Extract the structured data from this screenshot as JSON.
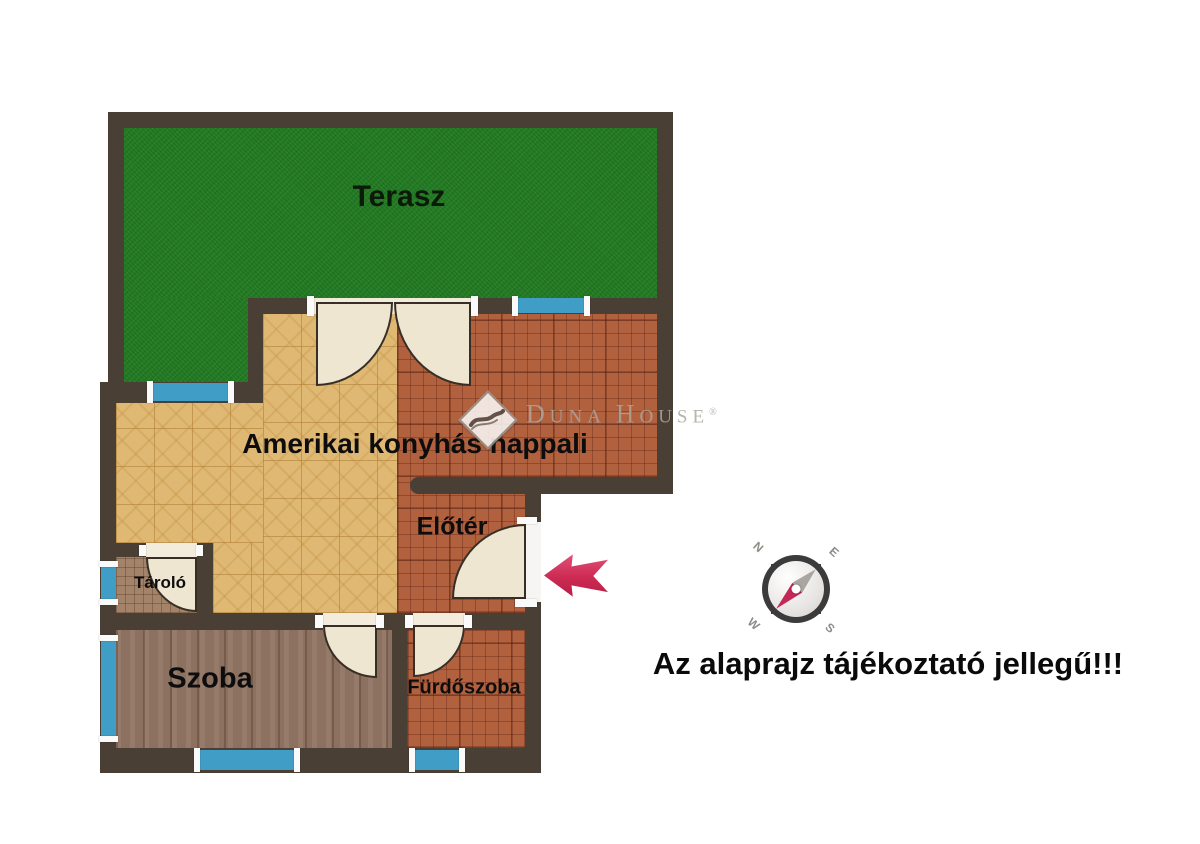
{
  "floorplan": {
    "rooms": {
      "terrace": {
        "label": "Terasz"
      },
      "living": {
        "label": "Amerikai konyhás nappali"
      },
      "foyer": {
        "label": "Előtér"
      },
      "storage": {
        "label": "Tároló"
      },
      "room": {
        "label": "Szoba"
      },
      "bathroom": {
        "label": "Fürdőszoba"
      }
    },
    "disclaimer": "Az alaprajz tájékoztató jellegű!!!",
    "watermark": {
      "d_initial": "D",
      "una": "UNA",
      "h_initial": "H",
      "ouse": "OUSE",
      "registered": "®",
      "icon": "duna-house-diamond-wave-icon"
    },
    "compass": {
      "icon": "compass-rose-icon",
      "north": "N",
      "east": "E",
      "west": "W",
      "south": "S"
    },
    "entrance_marker": {
      "icon": "entrance-arrow-icon",
      "direction": "left"
    },
    "colors": {
      "wall": "#493f35",
      "terrace_green": "#237b23",
      "parquet_tan": "#dfb873",
      "terracotta_tile": "#b2613f",
      "room_wood": "#8d7160",
      "storage_tile": "#a3846a",
      "window_blue": "#3f9dc6",
      "door_cream": "#efe6d2",
      "arrow_red": "#cc2a52",
      "needle_red": "#c32857"
    }
  }
}
